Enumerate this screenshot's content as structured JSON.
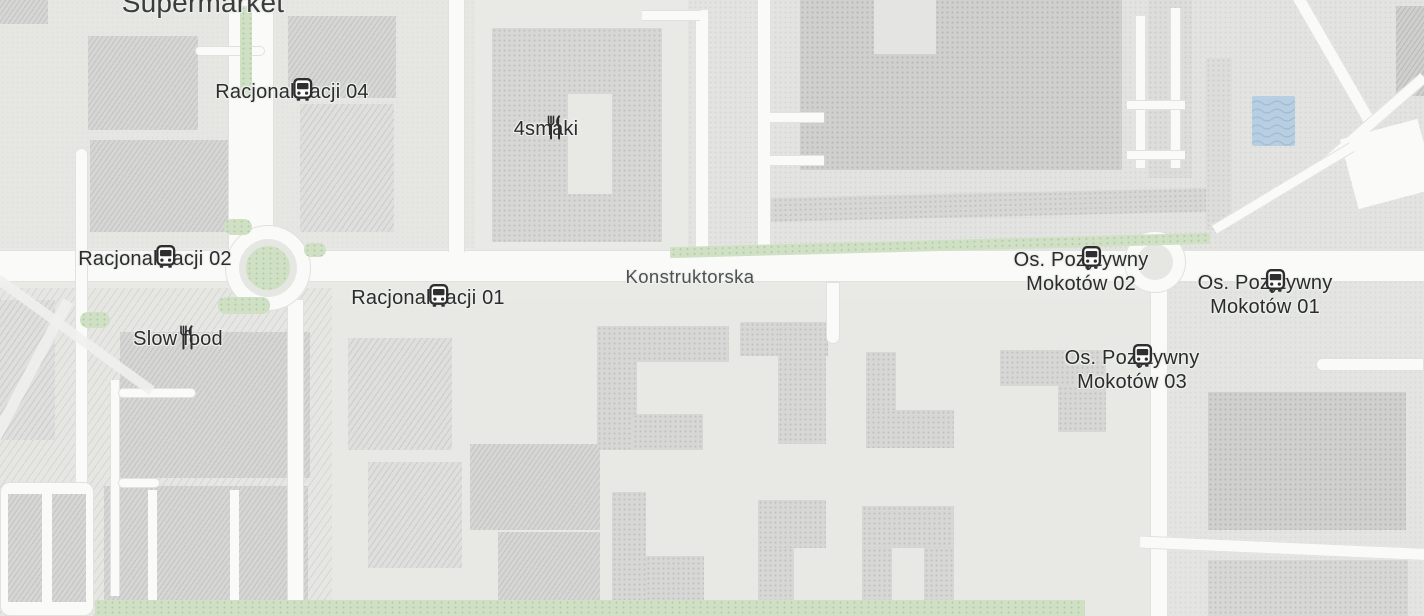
{
  "map": {
    "street": "Konstruktorska",
    "pois": [
      {
        "id": "supermarket",
        "label": "Supermarket",
        "kind": "area"
      },
      {
        "id": "racjonalizacji-04",
        "label": "Racjonalizacji 04",
        "kind": "bus-stop"
      },
      {
        "id": "4smaki",
        "label": "4smaki",
        "kind": "restaurant"
      },
      {
        "id": "racjonalizacji-02",
        "label": "Racjonalizacji 02",
        "kind": "bus-stop"
      },
      {
        "id": "slow-food",
        "label": "Slow food",
        "kind": "restaurant"
      },
      {
        "id": "racjonalizacji-01",
        "label": "Racjonalizacji 01",
        "kind": "bus-stop"
      },
      {
        "id": "os-pozytywny-mokotow-02",
        "label": "Os. Pozytywny Mokotów 02",
        "kind": "bus-stop"
      },
      {
        "id": "os-pozytywny-mokotow-01",
        "label": "Os. Pozytywny Mokotów 01",
        "kind": "bus-stop"
      },
      {
        "id": "os-pozytywny-mokotow-03",
        "label": "Os. Pozytywny Mokotów 03",
        "kind": "bus-stop"
      }
    ],
    "colors": {
      "ground": "#e9eae6",
      "building": "#d7d8d5",
      "building_dark": "#d0d1ce",
      "road": "#fafbf9",
      "green": "#cfe0c5",
      "water": "#b8cfe2",
      "poi_label": "#2c2c2e",
      "street_label": "#505054",
      "icon": "#2e2e30"
    }
  }
}
